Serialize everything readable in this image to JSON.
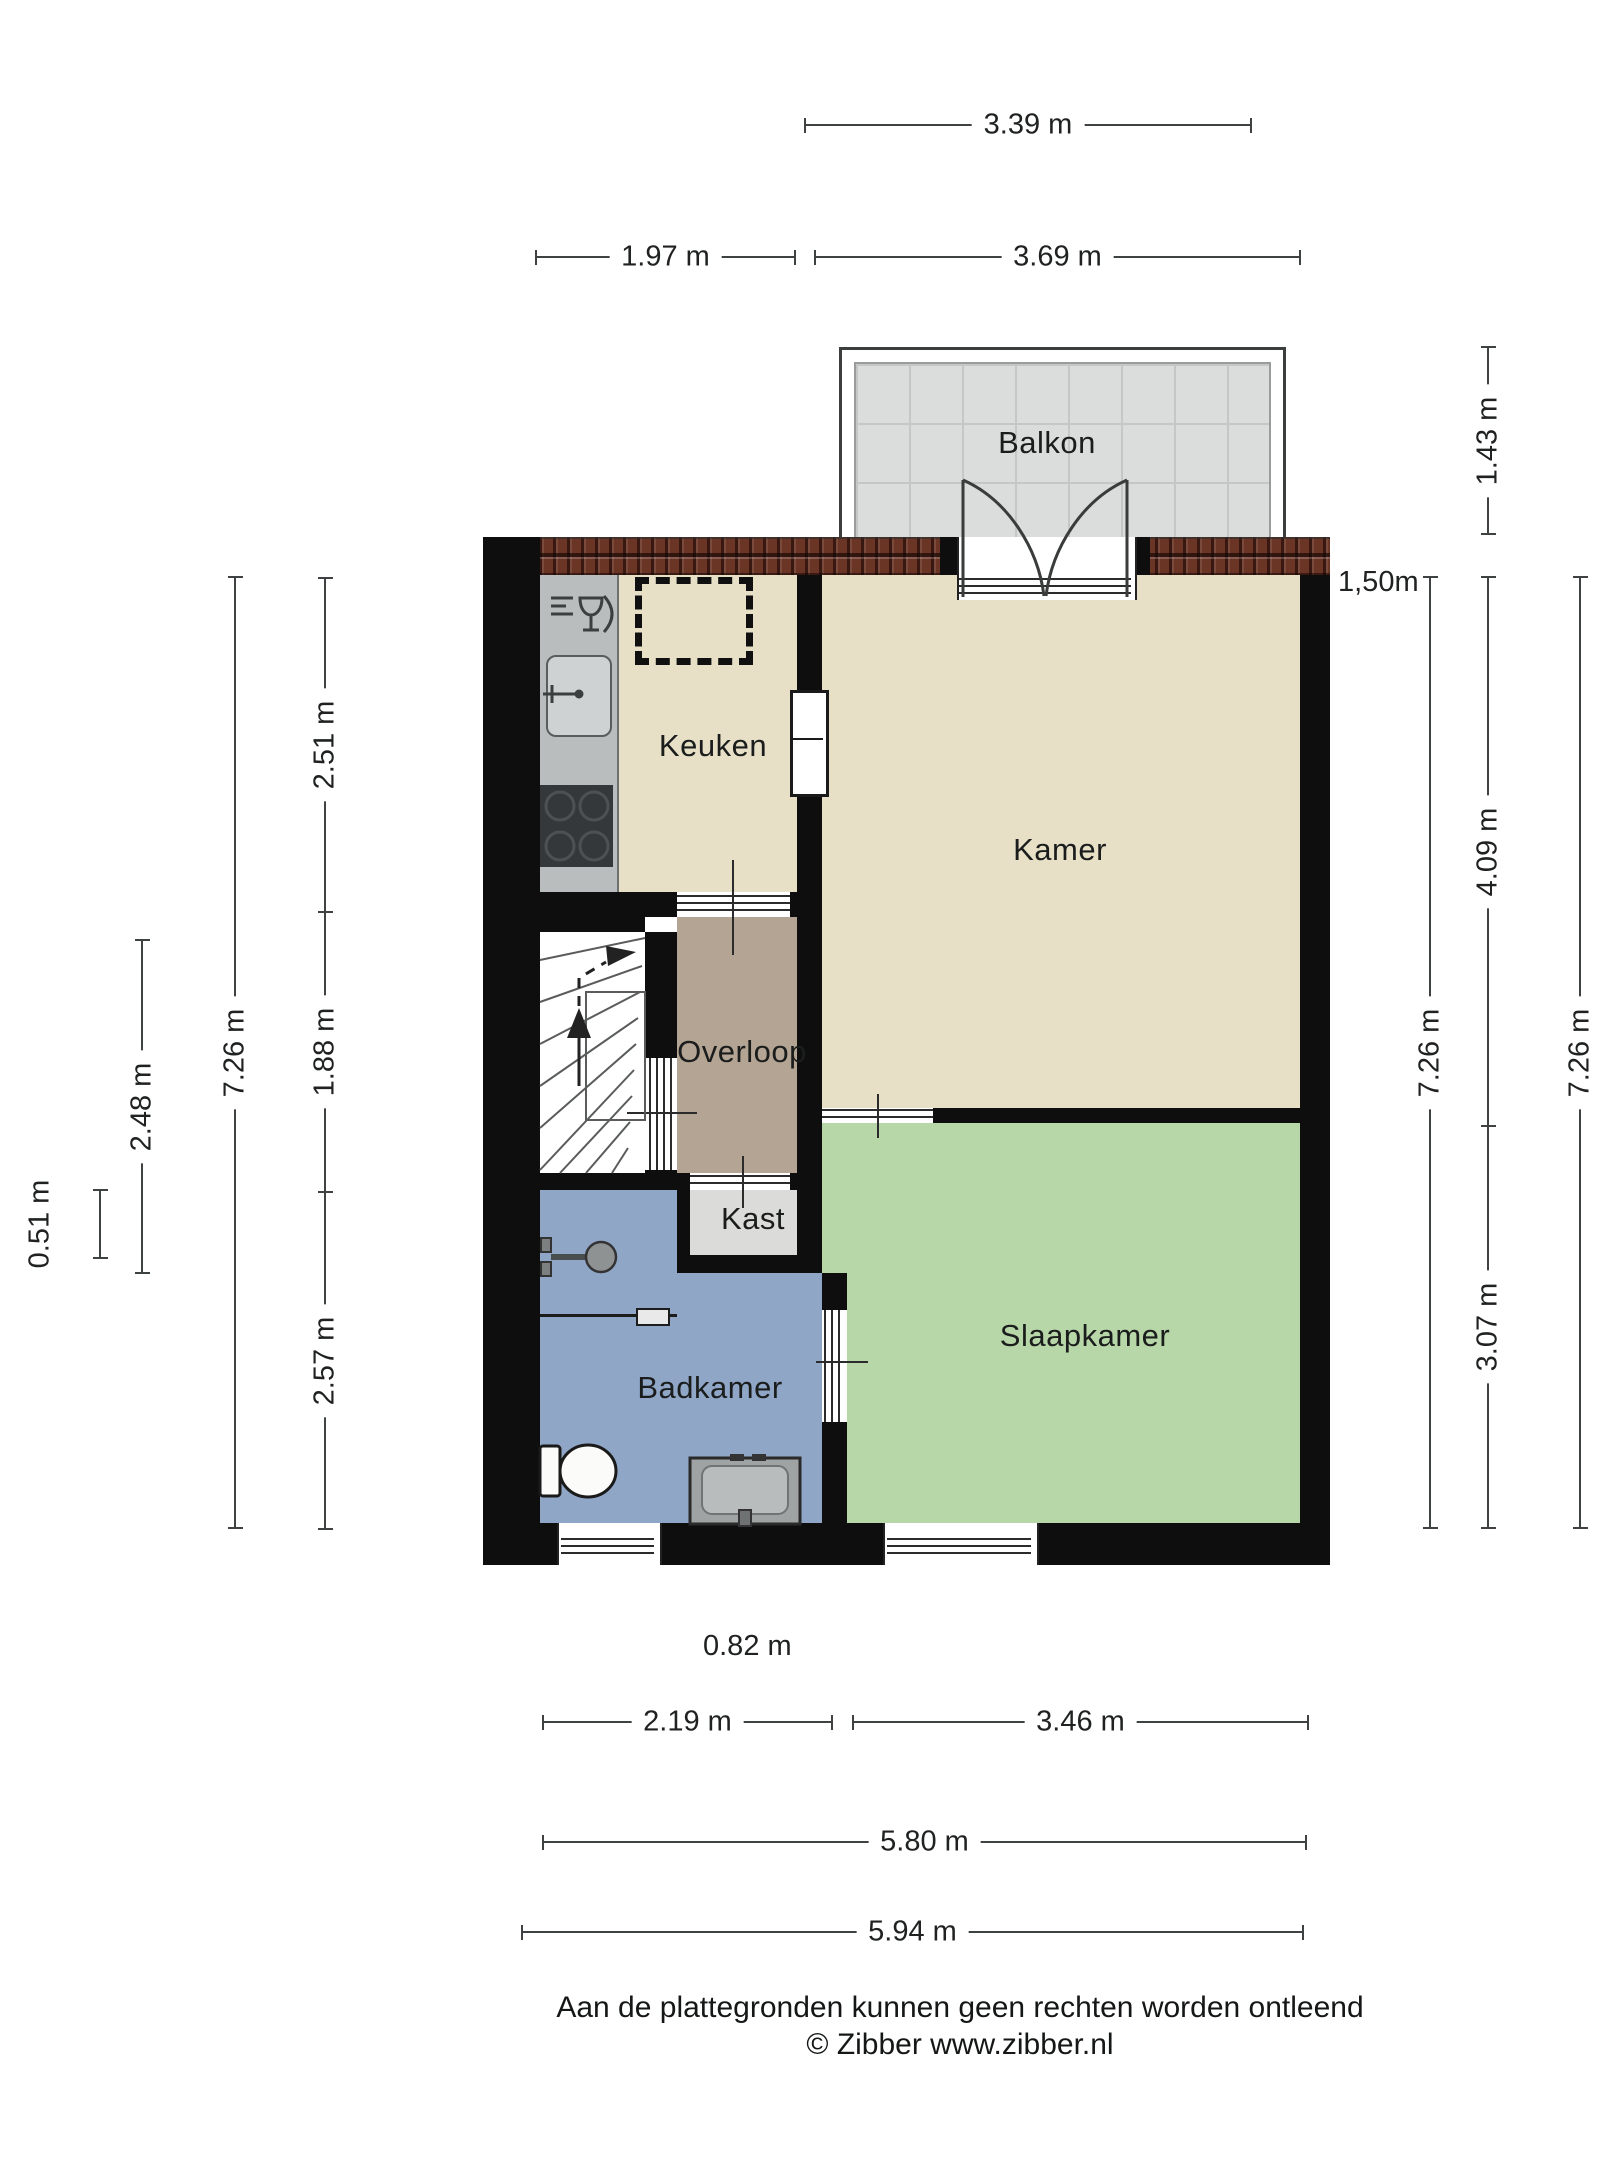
{
  "rooms": {
    "balkon": "Balkon",
    "keuken": "Keuken",
    "kamer": "Kamer",
    "overloop": "Overloop",
    "kast": "Kast",
    "badkamer": "Badkamer",
    "slaapkamer": "Slaapkamer"
  },
  "dimensions": {
    "top_balcony": "3.39 m",
    "top_keuken": "1.97 m",
    "top_kamer": "3.69 m",
    "left_kast_depth": "0.51 m",
    "left_stairs_column": "2.48 m",
    "left_total": "7.26 m",
    "left_keuken": "2.51 m",
    "left_overloop": "1.88 m",
    "left_badkamer": "2.57 m",
    "right_balcony": "1.43 m",
    "right_kamer": "4.09 m",
    "right_slaapkamer": "3.07 m",
    "right_total_inner": "7.26 m",
    "right_total_outer": "7.26 m",
    "bottom_free": "0.82 m",
    "bottom_badkamer": "2.19 m",
    "bottom_slaapkamer": "3.46 m",
    "bottom_inner": "5.80 m",
    "bottom_outer": "5.94 m",
    "height_marker": "1,50m"
  },
  "footer": {
    "line1": "Aan de plattegronden kunnen geen rechten worden ontleend",
    "line2": "© Zibber www.zibber.nl"
  },
  "colors": {
    "wall": "#0e0e0e",
    "floor_main": "#e7e0c7",
    "floor_overloop": "#b4a493",
    "floor_kast": "#dbdbd9",
    "floor_badkamer": "#8fa6c7",
    "floor_slaapkamer": "#b7d7a8",
    "balcony_tile": "#dbdcdc",
    "balcony_grid": "#c5c7c6",
    "roof": "#6b3526",
    "counter": "#b9bdbd",
    "counter_dark": "#35383a",
    "sink": "#ced2d2",
    "dim": "#3f4242",
    "text": "#1d1f1f"
  }
}
